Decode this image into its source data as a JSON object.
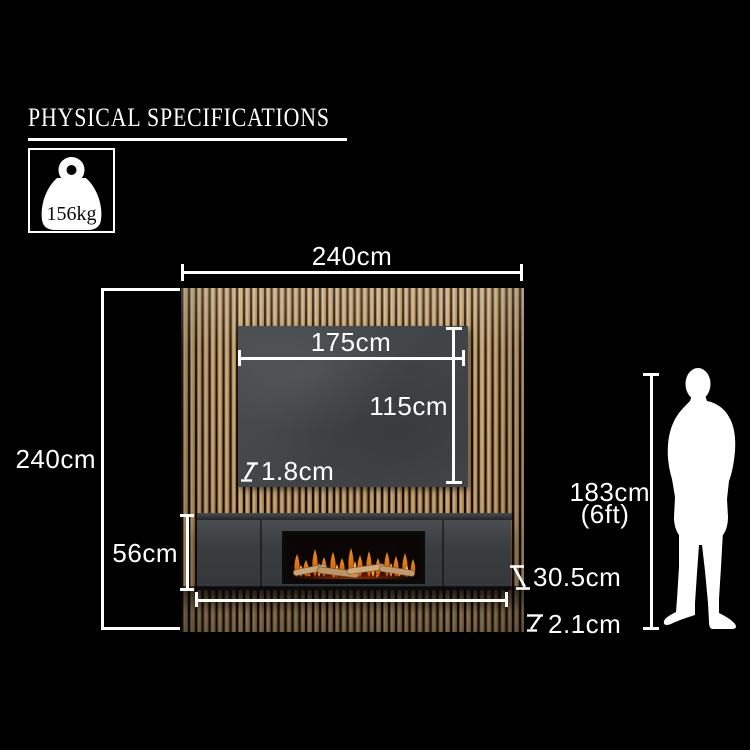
{
  "title": "PHYSICAL SPECIFICATIONS",
  "weight": {
    "value": "156kg"
  },
  "dims": {
    "total_width": "240cm",
    "total_height": "240cm",
    "panel_width": "175cm",
    "panel_height": "115cm",
    "panel_thickness": "1.8cm",
    "suite_height": "56cm",
    "suite_depth": "30.5cm",
    "base_thickness": "2.1cm",
    "person_cm": "183cm",
    "person_ft": "(6ft)"
  },
  "colors": {
    "background": "#000000",
    "dimension_lines": "#ffffff",
    "wood_light": "#d4b384",
    "wood_gap": "#17110a",
    "media_panel_grey": "#46494b",
    "suite_grey": "#3c4043",
    "flame_orange": "#ff8a1e",
    "flame_yellow": "#ffd24d",
    "log_tan": "#c9a478"
  }
}
